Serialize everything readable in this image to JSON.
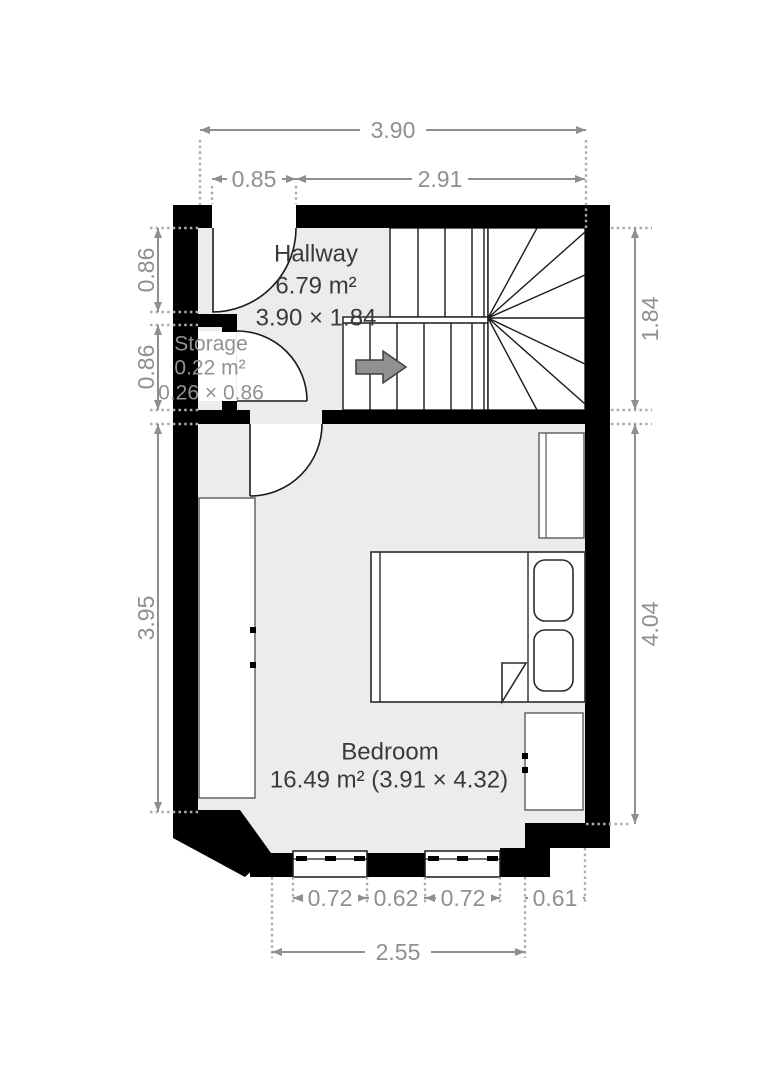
{
  "floorplan": {
    "rooms": {
      "hallway": {
        "name": "Hallway",
        "area": "6.79 m²",
        "dimensions": "3.90 × 1.84"
      },
      "storage": {
        "name": "Storage",
        "area": "0.22 m²",
        "dimensions": "0.26 × 0.86"
      },
      "bedroom": {
        "name": "Bedroom",
        "area_dimensions": "16.49 m² (3.91 × 4.32)"
      }
    },
    "dimensions": {
      "overall_width": "3.90",
      "entry_offset": "0.85",
      "stair_width": "2.91",
      "hallway_height_left": "0.86",
      "storage_height_left": "0.86",
      "bedroom_height_left": "3.95",
      "hallway_depth_right": "1.84",
      "bedroom_depth_right": "4.04",
      "window1_width": "0.72",
      "window_gap": "0.62",
      "window2_width": "0.72",
      "nook_width": "0.61",
      "windows_total": "2.55"
    },
    "icons": {
      "stair_direction": "right-arrow"
    },
    "colors": {
      "wall": "#000000",
      "floor": "#ebecee",
      "dimension_text": "#8c9094",
      "room_text": "#3a3a3a",
      "storage_text": "#8f9296",
      "stair_arrow_fill": "#909090"
    }
  }
}
